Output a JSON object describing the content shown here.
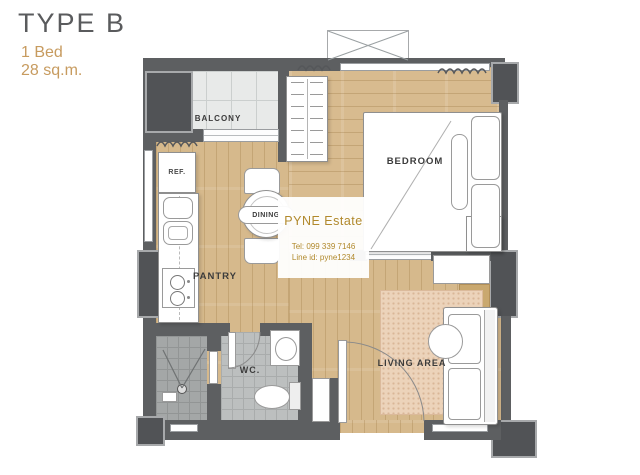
{
  "header": {
    "type_label": "TYPE B",
    "bed_label": "1 Bed",
    "area_label": "28 sq.m."
  },
  "rooms": {
    "balcony": "BALCONY",
    "bedroom": "BEDROOM",
    "dining": "DINING",
    "pantry": "PANTRY",
    "wc": "WC.",
    "living_area": "LIVING AREA",
    "refrigerator": "REF."
  },
  "watermark": {
    "brand": "PYNE Estate",
    "tel": "Tel: 099 339 7146",
    "line_id": "Line id: pyne1234"
  },
  "colors": {
    "title_gray": "#5a5b5d",
    "accent_gold": "#c79b5f",
    "watermark_gold": "#b1892c",
    "wall": "#5d5f61",
    "wood_floor": "#d7ba8e",
    "balcony_tile": "#e8eae9",
    "wc_tile": "#bcbfbf",
    "shower_tile": "#a4a7a7",
    "rug": "#ecd3ba"
  }
}
